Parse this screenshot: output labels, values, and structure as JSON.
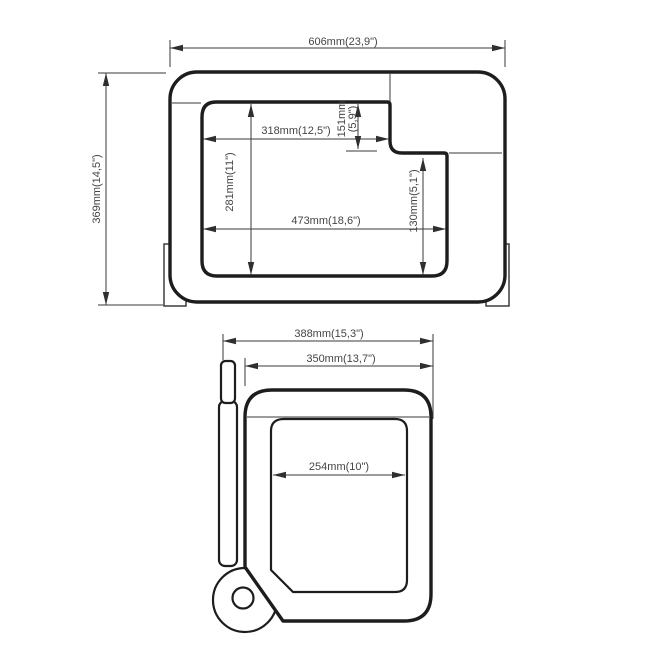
{
  "colors": {
    "background": "#ffffff",
    "line": "#1d1d1d",
    "dimension_line": "#3a3a3a",
    "text": "#454545"
  },
  "front_view": {
    "overall_width": "606mm(23,9\")",
    "overall_height": "369mm(14,5\")",
    "opening_top_width": "318mm(12,5\")",
    "notch_depth_mm": "151mm",
    "notch_depth_in": "(5,9\")",
    "opening_height": "281mm(11\")",
    "opening_bottom_width": "473mm(18,6\")",
    "opening_right_height": "130mm(5,1\")"
  },
  "side_view": {
    "overall_depth": "388mm(15,3\")",
    "body_depth": "350mm(13,7\")",
    "opening_depth": "254mm(10\")"
  }
}
